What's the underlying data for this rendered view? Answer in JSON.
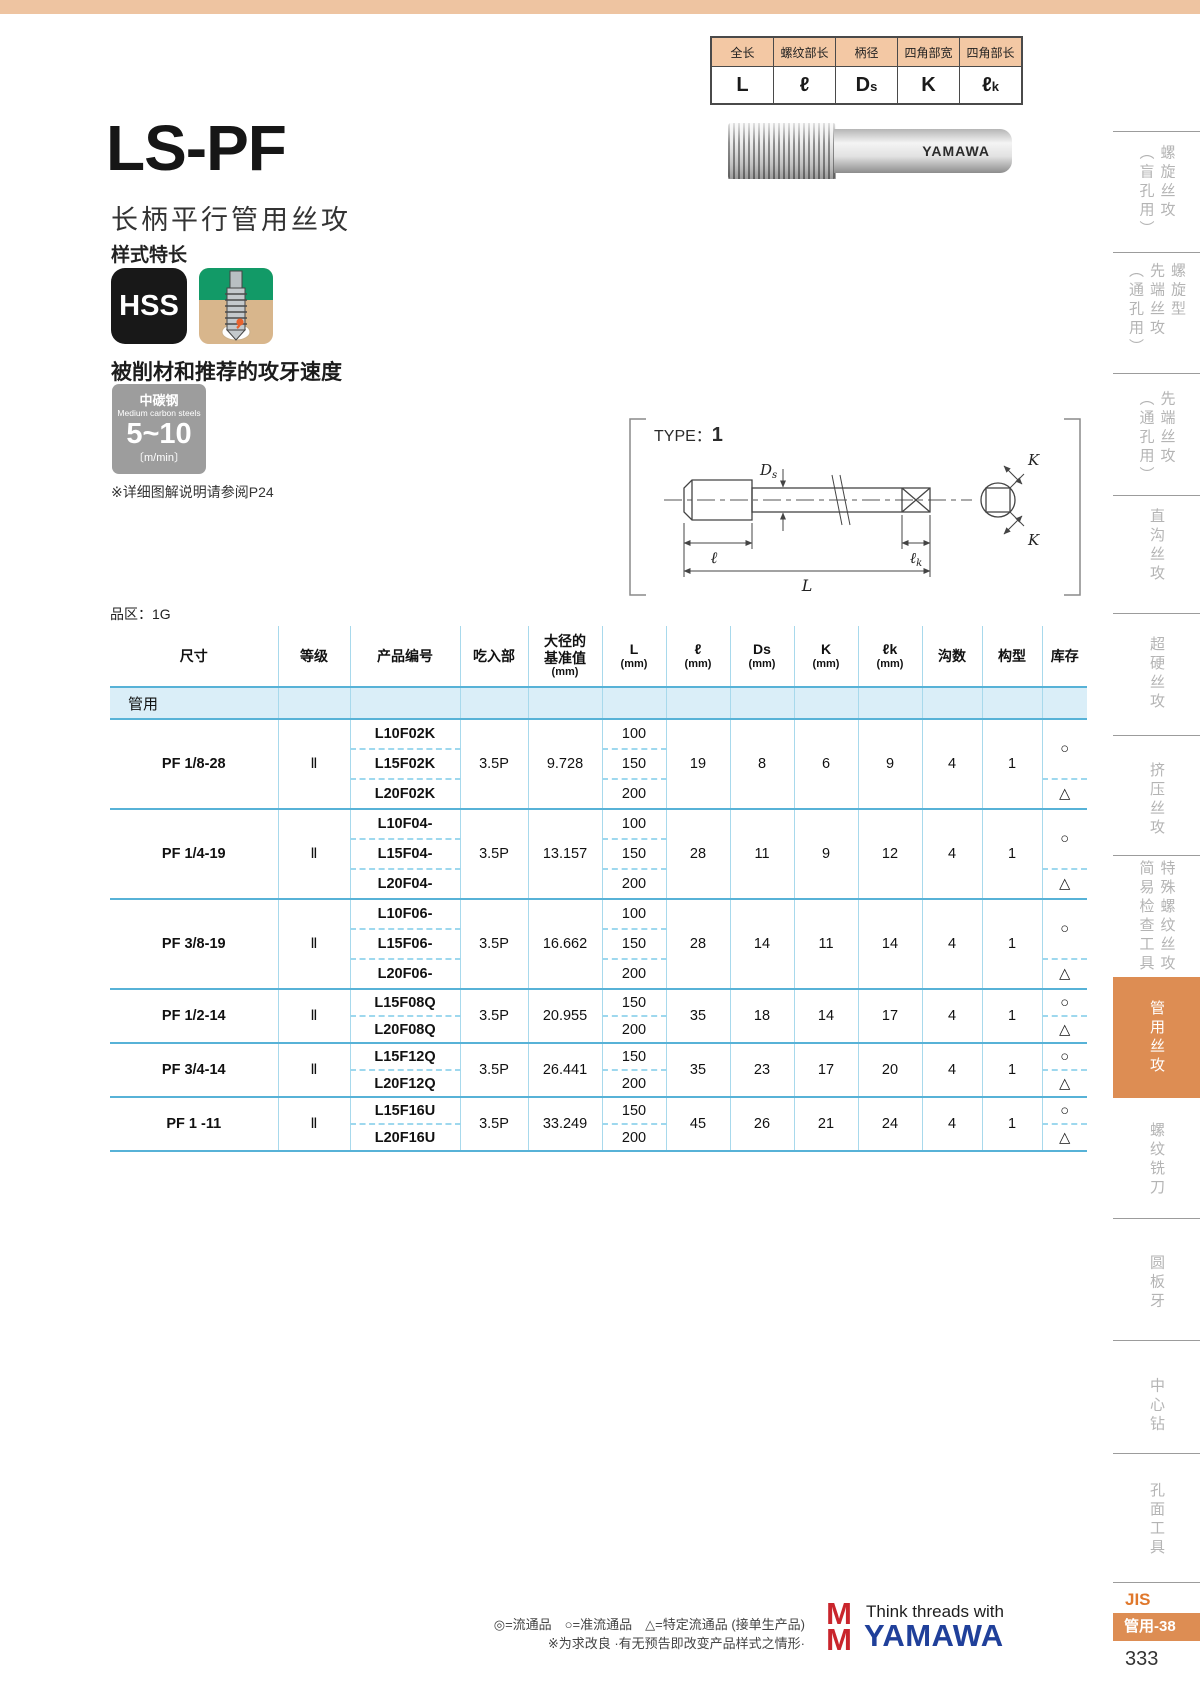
{
  "top_legend": {
    "headers": [
      "全长",
      "螺纹部长",
      "柄径",
      "四角部宽",
      "四角部长"
    ],
    "values": [
      {
        "main": "L",
        "sub": ""
      },
      {
        "main": "ℓ",
        "sub": ""
      },
      {
        "main": "D",
        "sub": "s"
      },
      {
        "main": "K",
        "sub": ""
      },
      {
        "main": "ℓ",
        "sub": "k"
      }
    ]
  },
  "hero": {
    "model": "LS-PF",
    "name": "长柄平行管用丝攻",
    "style_note": "样式特长",
    "hss": "HSS",
    "photo_brand": "YAMAWA"
  },
  "speed": {
    "heading": "被削材和推荐的攻牙速度",
    "material_cn": "中碳钢",
    "material_en": "Medium carbon steels",
    "value": "5~10",
    "unit": "〔m/min〕",
    "ref_note": "※详细图解说明请参阅P24"
  },
  "diagram": {
    "type_label": "TYPE：",
    "type_value": "1",
    "labels": {
      "ds_main": "D",
      "ds_sub": "s",
      "ell": "ℓ",
      "L": "L",
      "lk_main": "ℓ",
      "lk_sub": "k",
      "K1": "K",
      "K2": "K"
    }
  },
  "spec_table": {
    "zone": "品区：1G",
    "columns": [
      [
        "尺寸"
      ],
      [
        "等级"
      ],
      [
        "产品编号"
      ],
      [
        "吃入部"
      ],
      [
        "大径的",
        "基准值",
        "(mm)"
      ],
      [
        "L",
        "(mm)"
      ],
      [
        "ℓ",
        "(mm)"
      ],
      [
        "Ds",
        "(mm)"
      ],
      [
        "K",
        "(mm)"
      ],
      [
        "ℓk",
        "(mm)"
      ],
      [
        "沟数"
      ],
      [
        "构型"
      ],
      [
        "库存"
      ]
    ],
    "section": "管用",
    "groups": [
      {
        "size": "PF 1/8-28",
        "grade": "Ⅱ",
        "chamfer": "3.5P",
        "major_dia": "9.728",
        "ell": "19",
        "ds": "8",
        "k": "6",
        "lk": "9",
        "flutes": "4",
        "type": "1",
        "rows": [
          {
            "code": "L10F02K",
            "L": "100"
          },
          {
            "code": "L15F02K",
            "L": "150"
          },
          {
            "code": "L20F02K",
            "L": "200"
          }
        ],
        "stock": [
          {
            "sym": "○",
            "rows": 2
          },
          {
            "sym": "△",
            "rows": 1
          }
        ]
      },
      {
        "size": "PF 1/4-19",
        "grade": "Ⅱ",
        "chamfer": "3.5P",
        "major_dia": "13.157",
        "ell": "28",
        "ds": "11",
        "k": "9",
        "lk": "12",
        "flutes": "4",
        "type": "1",
        "rows": [
          {
            "code": "L10F04-",
            "L": "100"
          },
          {
            "code": "L15F04-",
            "L": "150"
          },
          {
            "code": "L20F04-",
            "L": "200"
          }
        ],
        "stock": [
          {
            "sym": "○",
            "rows": 2
          },
          {
            "sym": "△",
            "rows": 1
          }
        ]
      },
      {
        "size": "PF 3/8-19",
        "grade": "Ⅱ",
        "chamfer": "3.5P",
        "major_dia": "16.662",
        "ell": "28",
        "ds": "14",
        "k": "11",
        "lk": "14",
        "flutes": "4",
        "type": "1",
        "rows": [
          {
            "code": "L10F06-",
            "L": "100"
          },
          {
            "code": "L15F06-",
            "L": "150"
          },
          {
            "code": "L20F06-",
            "L": "200"
          }
        ],
        "stock": [
          {
            "sym": "○",
            "rows": 2
          },
          {
            "sym": "△",
            "rows": 1
          }
        ]
      },
      {
        "size": "PF 1/2-14",
        "grade": "Ⅱ",
        "chamfer": "3.5P",
        "major_dia": "20.955",
        "ell": "35",
        "ds": "18",
        "k": "14",
        "lk": "17",
        "flutes": "4",
        "type": "1",
        "rows": [
          {
            "code": "L15F08Q",
            "L": "150"
          },
          {
            "code": "L20F08Q",
            "L": "200"
          }
        ],
        "stock": [
          {
            "sym": "○",
            "rows": 1
          },
          {
            "sym": "△",
            "rows": 1
          }
        ]
      },
      {
        "size": "PF 3/4-14",
        "grade": "Ⅱ",
        "chamfer": "3.5P",
        "major_dia": "26.441",
        "ell": "35",
        "ds": "23",
        "k": "17",
        "lk": "20",
        "flutes": "4",
        "type": "1",
        "rows": [
          {
            "code": "L15F12Q",
            "L": "150"
          },
          {
            "code": "L20F12Q",
            "L": "200"
          }
        ],
        "stock": [
          {
            "sym": "○",
            "rows": 1
          },
          {
            "sym": "△",
            "rows": 1
          }
        ]
      },
      {
        "size": "PF 1 -11",
        "grade": "Ⅱ",
        "chamfer": "3.5P",
        "major_dia": "33.249",
        "ell": "45",
        "ds": "26",
        "k": "21",
        "lk": "24",
        "flutes": "4",
        "type": "1",
        "rows": [
          {
            "code": "L15F16U",
            "L": "150"
          },
          {
            "code": "L20F16U",
            "L": "200"
          }
        ],
        "stock": [
          {
            "sym": "○",
            "rows": 1
          },
          {
            "sym": "△",
            "rows": 1
          }
        ]
      }
    ]
  },
  "sidebar": {
    "items": [
      {
        "columns": [
          "螺旋丝攻",
          "（盲孔用）"
        ],
        "active": false
      },
      {
        "columns": [
          "螺旋型",
          "先端丝攻",
          "（通孔用）"
        ],
        "active": false
      },
      {
        "columns": [
          "先端丝攻",
          "（通孔用）"
        ],
        "active": false
      },
      {
        "columns": [
          "直沟丝攻"
        ],
        "active": false
      },
      {
        "columns": [
          "超硬丝攻"
        ],
        "active": false
      },
      {
        "columns": [
          "挤压丝攻"
        ],
        "active": false
      },
      {
        "columns": [
          "特殊螺纹丝攻",
          "简易检查工具"
        ],
        "active": false
      },
      {
        "columns": [
          "管用丝攻"
        ],
        "active": true
      },
      {
        "columns": [
          "螺纹铣刀"
        ],
        "active": false
      },
      {
        "columns": [
          "圆板牙"
        ],
        "active": false
      },
      {
        "columns": [
          "中心钻"
        ],
        "active": false
      },
      {
        "columns": [
          "孔面工具"
        ],
        "active": false
      }
    ]
  },
  "footer": {
    "legend": "◎=流通品　○=准流通品　△=特定流通品 (接单生产品)",
    "note": "※为求改良 ·有无预告即改变产品样式之情形·",
    "tagline": "Think threads with",
    "brand": "YAMAWA",
    "jis": "JIS",
    "jis_tab": "管用-38",
    "page_no": "333"
  }
}
